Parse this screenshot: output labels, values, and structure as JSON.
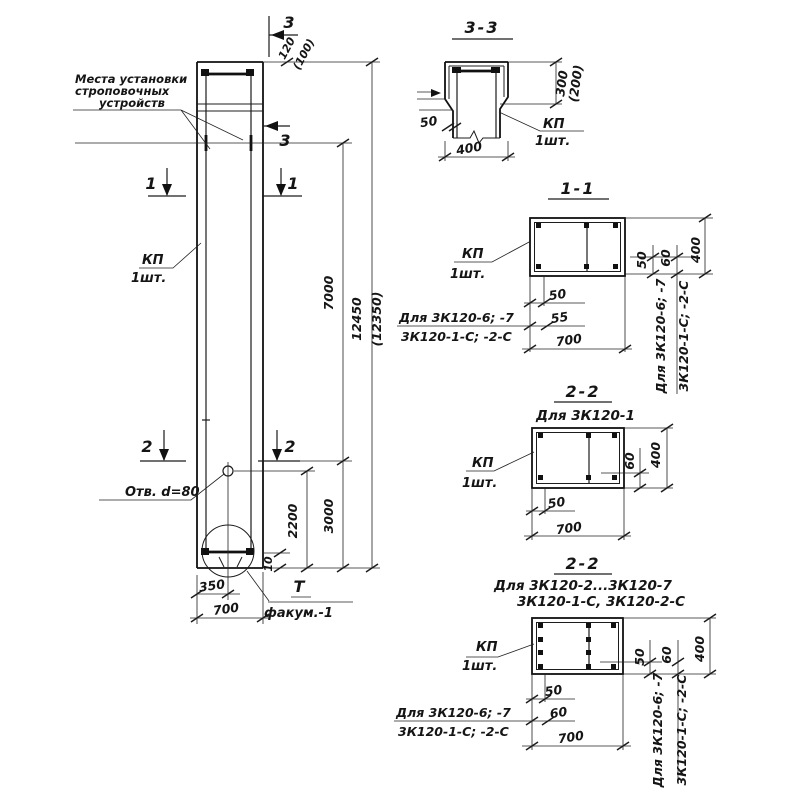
{
  "note": {
    "line1": "Места установки",
    "line2": "строповочных",
    "line3": "устройств"
  },
  "labels": {
    "kp": "КП",
    "qty": "1шт.",
    "hole": "Отв. d=80",
    "detail_mark": "Т",
    "detail_name": "факум.-1"
  },
  "markers": {
    "m1": "1",
    "m2": "2",
    "m3": "3"
  },
  "conditions": {
    "line1": "Для 3К120-6; -7",
    "line2": "3К120-1-С; -2-С"
  },
  "main_dims": {
    "top": "120",
    "top_alt": "(100)",
    "len_strop": "7000",
    "len_total": "12450",
    "len_total_alt": "(12350)",
    "hole_to_end": "2200",
    "cut2_to_end": "3000",
    "gap": "10",
    "w350": "350",
    "w700": "700"
  },
  "s33": {
    "title": "3-3",
    "h": "300",
    "h_alt": "(200)",
    "cover": "50",
    "w": "400"
  },
  "s11": {
    "title": "1-1",
    "d50": "50",
    "d55": "55",
    "w": "700",
    "r50": "50",
    "r60": "60",
    "rh": "400"
  },
  "s22a": {
    "title": "2-2",
    "subtitle": "Для 3К120-1",
    "d50": "50",
    "w": "700",
    "r60": "60",
    "rh": "400"
  },
  "s22b": {
    "title": "2-2",
    "subtitle1": "Для 3К120-2...3К120-7",
    "subtitle2": "3К120-1-С, 3К120-2-С",
    "d50": "50",
    "d60": "60",
    "w": "700",
    "r50": "50",
    "r60": "60",
    "rh": "400"
  }
}
